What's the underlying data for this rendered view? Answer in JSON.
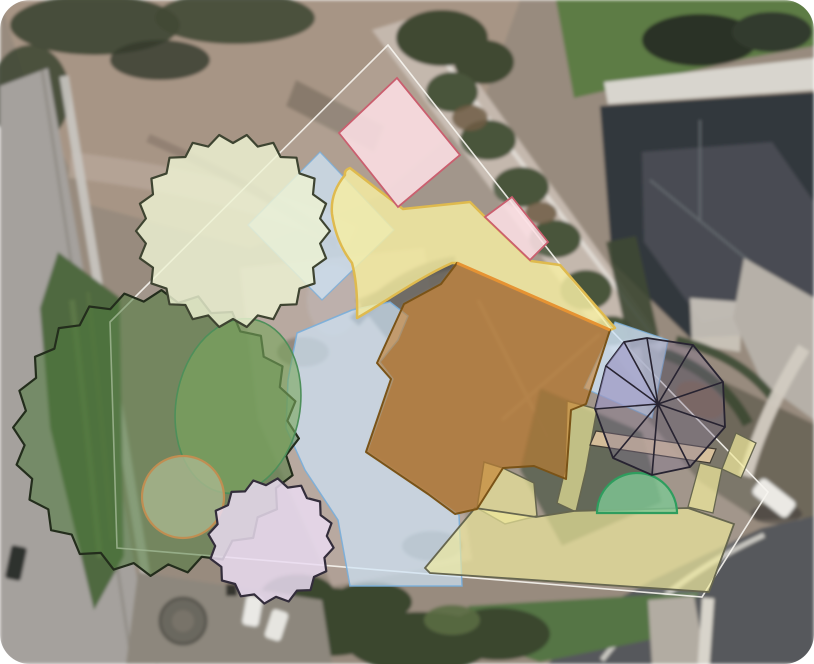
{
  "canvas": {
    "width": 814,
    "height": 664,
    "corner_radius": 30,
    "page_background": "#ffffff"
  },
  "design_overlays": {
    "property_line_color": "#f7f5ef",
    "path_fill": "#f6eea2",
    "path_stroke": "#dfba4e",
    "drive_fill": "#f2eb9c",
    "drive_stroke": "#66664f",
    "patio_fill": "#cfe4f7",
    "patio_stroke": "#79aeda",
    "bed_fill": "#fcdfe4",
    "bed_stroke": "#ca5f6f",
    "house_fill": "#c8802f",
    "house_stroke": "#7a5317",
    "house_ridge_stroke": "#e69333",
    "tree_light_fill": "#eef3d3",
    "tree_light_stroke": "#3e4431",
    "tree_dark_fill": "#4f7a3c",
    "tree_dark_stroke": "#232d1c",
    "tree_lilac_fill": "#eadcf1",
    "tree_lilac_stroke": "#332d3b",
    "umbrella_fill": "#7d7190",
    "umbrella_stroke": "#272331",
    "umbrella_facet_fill": "#a7a3d6",
    "shrub_fill": "#79a65e",
    "shrub_stroke": "#4e8f5a",
    "shrub_circle_fill": "#a9b78e",
    "shrub_circle_stroke": "#c08e52",
    "lawn_arc_fill": "#7ec794",
    "lawn_arc_stroke": "#2f9d5e",
    "band_fill": "#e7cda4",
    "band_stroke": "#403b32"
  }
}
